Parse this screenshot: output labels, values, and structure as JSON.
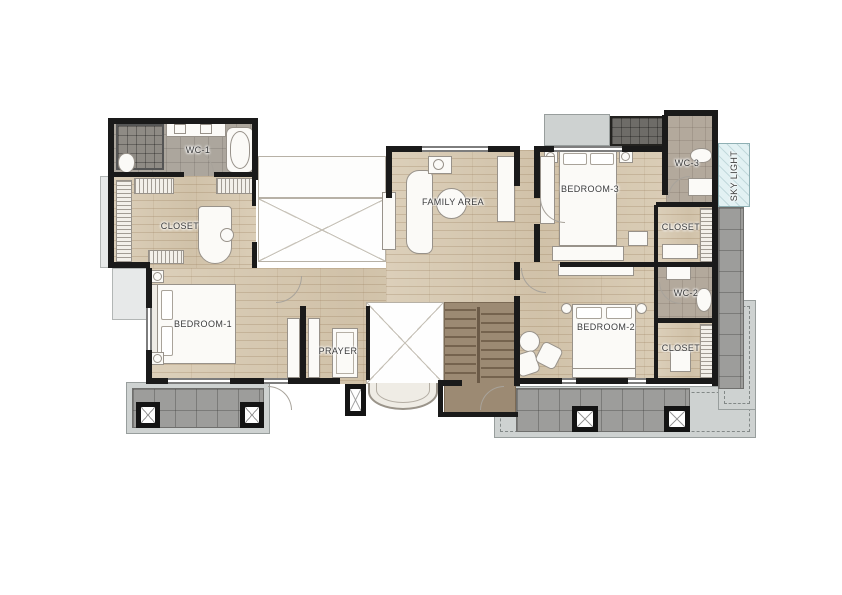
{
  "rooms": {
    "wc1": "WC-1",
    "closet_master": "CLOSET",
    "bedroom1": "BEDROOM-1",
    "prayer": "PRAYER",
    "family_area": "FAMILY AREA",
    "bedroom3": "BEDROOM-3",
    "wc3": "WC-3",
    "skylight": "SKY LIGHT",
    "closet_bedroom3": "CLOSET",
    "wc2": "WC-2",
    "bedroom2": "BEDROOM-2",
    "closet_bedroom2": "CLOSET"
  },
  "colors": {
    "wall": "#1a1a1a",
    "wood_floor": "#d8cab2",
    "bath_floor": "#aca69d",
    "bath_floor_warm": "#b3a99c",
    "balcony_tile": "#9d9d9b",
    "overhang": "#ced2d1",
    "stairs": "#9c8a73",
    "skylight_fill": "#e2f1f3",
    "dark_tile": "#6e6c68"
  }
}
